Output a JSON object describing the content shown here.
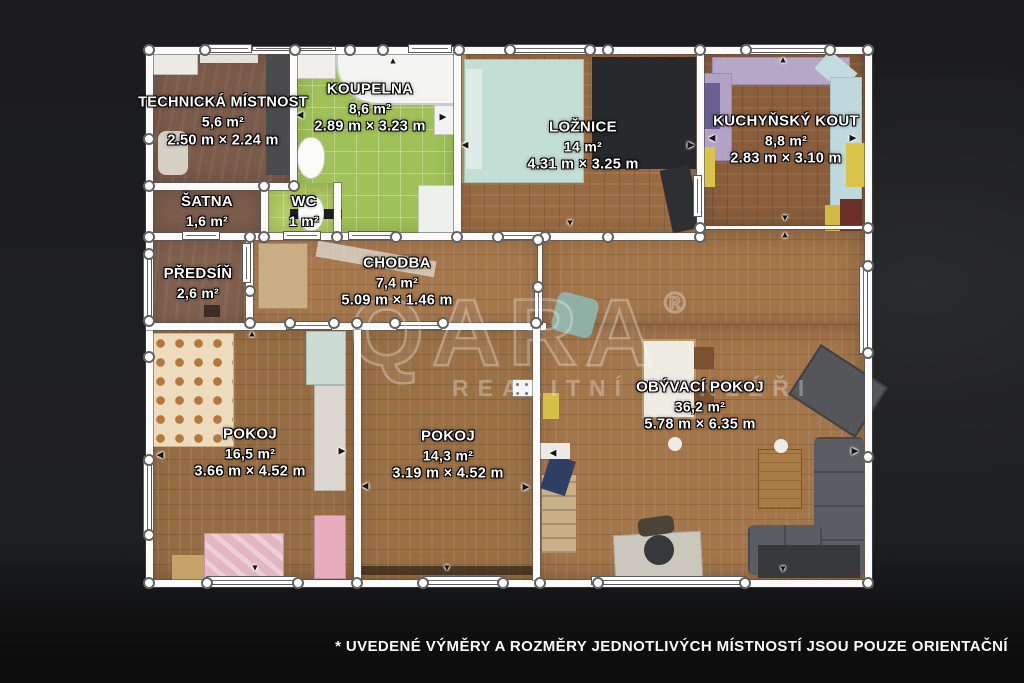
{
  "plan": {
    "rooms": [
      {
        "id": "technicka-mistnost",
        "name": "TECHNICKÁ MÍSTNOST",
        "area": "5,6 m²",
        "dims": "2.50 m × 2.24 m"
      },
      {
        "id": "koupelna",
        "name": "KOUPELNA",
        "area": "8,6 m²",
        "dims": "2.89 m × 3.23 m"
      },
      {
        "id": "loznice",
        "name": "LOŽNICE",
        "area": "14 m²",
        "dims": "4.31 m × 3.25 m"
      },
      {
        "id": "kuchynsky-kout",
        "name": "KUCHYŇSKÝ KOUT",
        "area": "8,8 m²",
        "dims": "2.83 m × 3.10 m"
      },
      {
        "id": "satna",
        "name": "ŠATNA",
        "area": "1,6 m²",
        "dims": ""
      },
      {
        "id": "wc",
        "name": "WC",
        "area": "1 m²",
        "dims": ""
      },
      {
        "id": "predsin",
        "name": "PŘEDSÍŇ",
        "area": "2,6 m²",
        "dims": ""
      },
      {
        "id": "chodba",
        "name": "CHODBA",
        "area": "7,4 m²",
        "dims": "5.09 m × 1.46 m"
      },
      {
        "id": "pokoj-1",
        "name": "POKOJ",
        "area": "16,5 m²",
        "dims": "3.66 m × 4.52 m"
      },
      {
        "id": "pokoj-2",
        "name": "POKOJ",
        "area": "14,3 m²",
        "dims": "3.19 m × 4.52 m"
      },
      {
        "id": "obyvaci-pokoj",
        "name": "OBÝVACÍ POKOJ",
        "area": "36,2 m²",
        "dims": "5.78 m × 6.35 m"
      }
    ]
  },
  "watermark": {
    "brand": "QARA",
    "registered": "®",
    "tagline": "REALITNÍ MAKLÉŘI"
  },
  "footer": {
    "disclaimer": "* UVEDENÉ VÝMĚRY A ROZMĚRY JEDNOTLIVÝCH MÍSTNOSTÍ JSOU POUZE ORIENTAČNÍ"
  },
  "icons": {
    "arrow_up": "▲",
    "arrow_down": "▼",
    "arrow_left": "◀",
    "arrow_right": "▶"
  },
  "colors": {
    "wall": "#fbfbfb",
    "background": "#202124",
    "bathroom_tile": "#9fc157",
    "wc_tile": "#b4cf66",
    "wood_bedroom": "#9a6b42",
    "wood_kitchen": "#8a5e3b",
    "wood_hall": "#a7784d",
    "wood_living": "#a3754a",
    "tech_floor": "#7a5a49",
    "watermark": "rgba(255,255,255,0.33)",
    "label_text": "#ffffff"
  }
}
